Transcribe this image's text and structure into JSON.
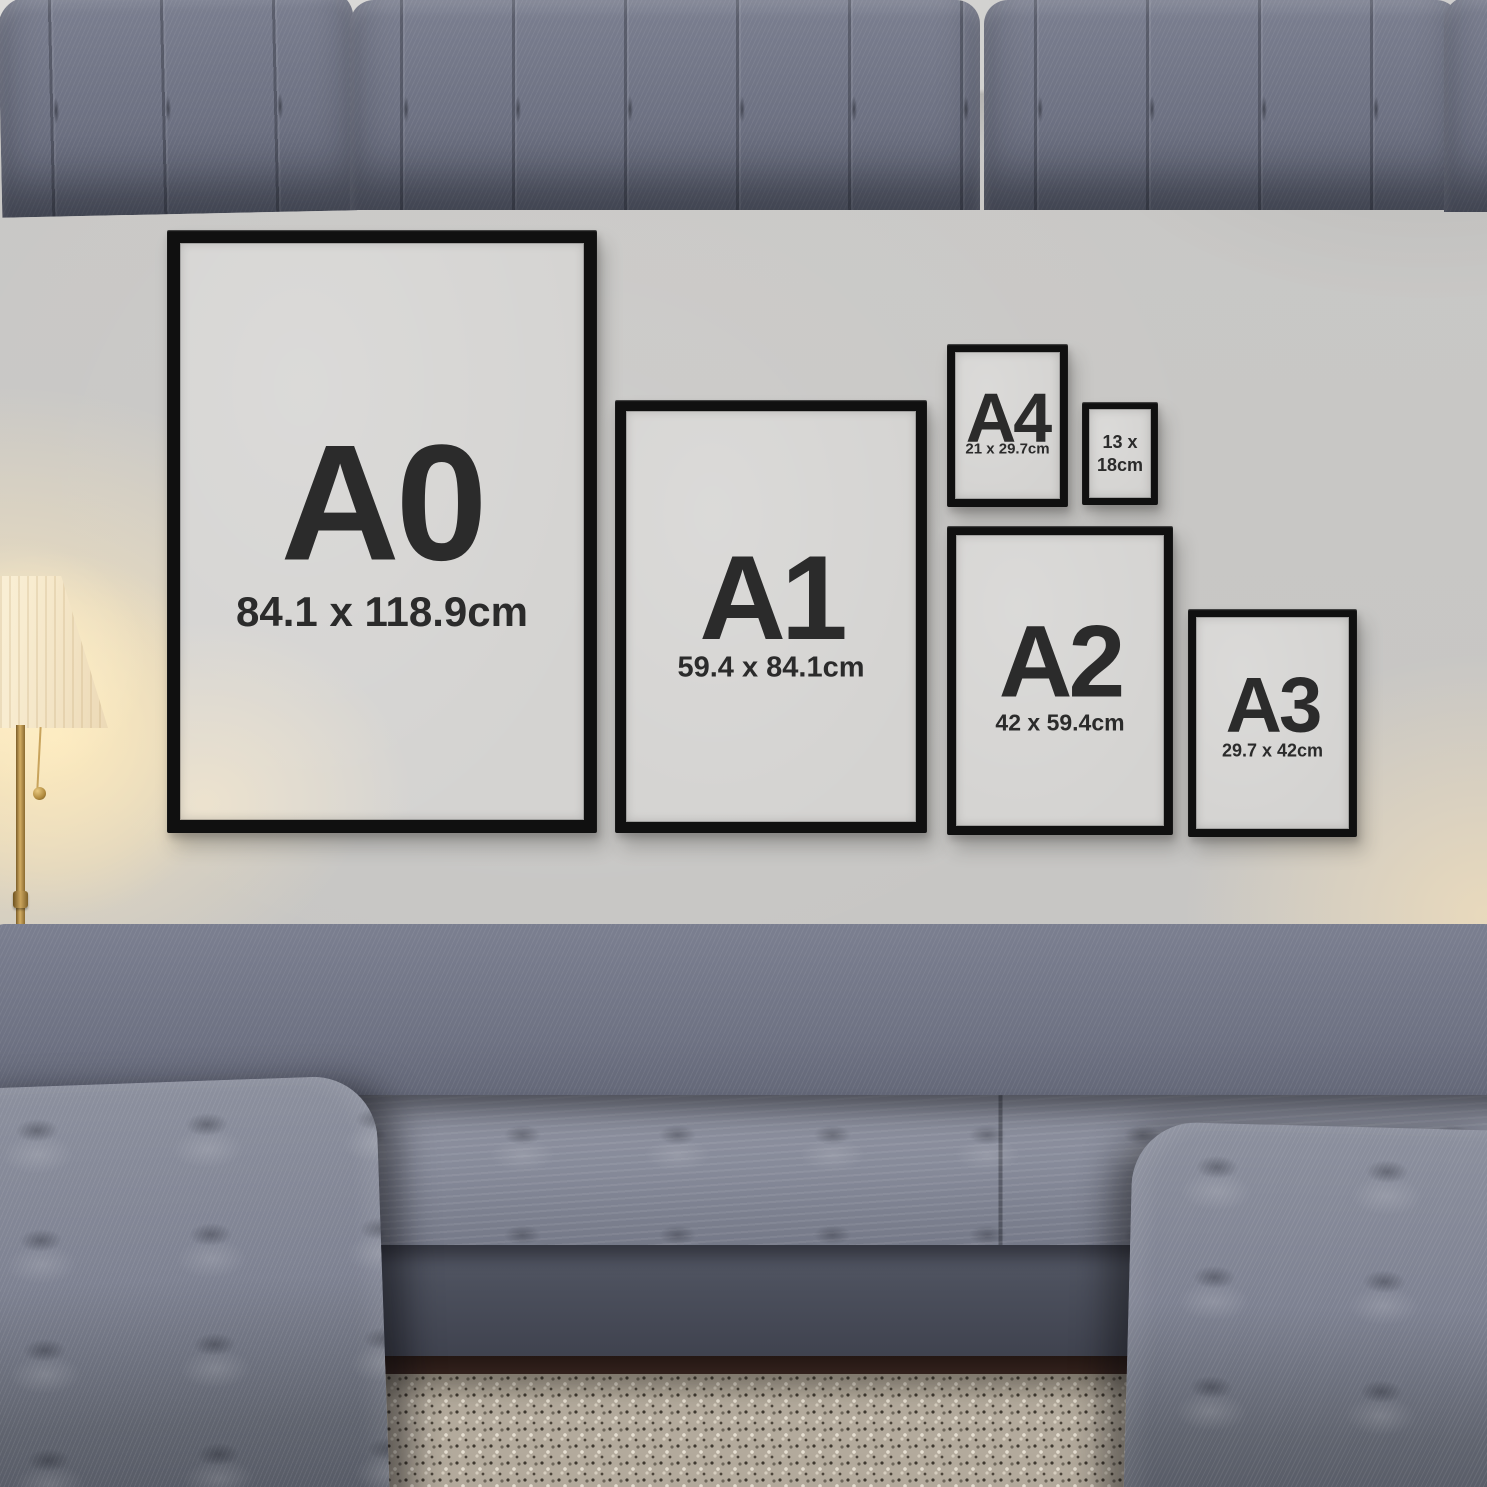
{
  "frames": [
    {
      "code": "A0",
      "dims": "84.1 x 118.9cm"
    },
    {
      "code": "A1",
      "dims": "59.4 x 84.1cm"
    },
    {
      "code": "A4",
      "dims": "21 x 29.7cm"
    },
    {
      "code": "",
      "dims": "13 x\n18cm"
    },
    {
      "code": "A2",
      "dims": "42 x 59.4cm"
    },
    {
      "code": "A3",
      "dims": "29.7 x 42cm"
    }
  ],
  "colors": {
    "frame_border": "#101010",
    "frame_mat": "#d4d3d1",
    "label_text": "#2b2b2b",
    "wall": "#c7c6c4",
    "ceiling": "#d6d5d3",
    "sofa_fabric": "#6f7384",
    "sofa_base": "#4c505d",
    "rug": "#b3aa9c",
    "floor": "#35231e",
    "lamp_glow": "#ffe6b0",
    "lamp_brass": "#caa45c"
  }
}
